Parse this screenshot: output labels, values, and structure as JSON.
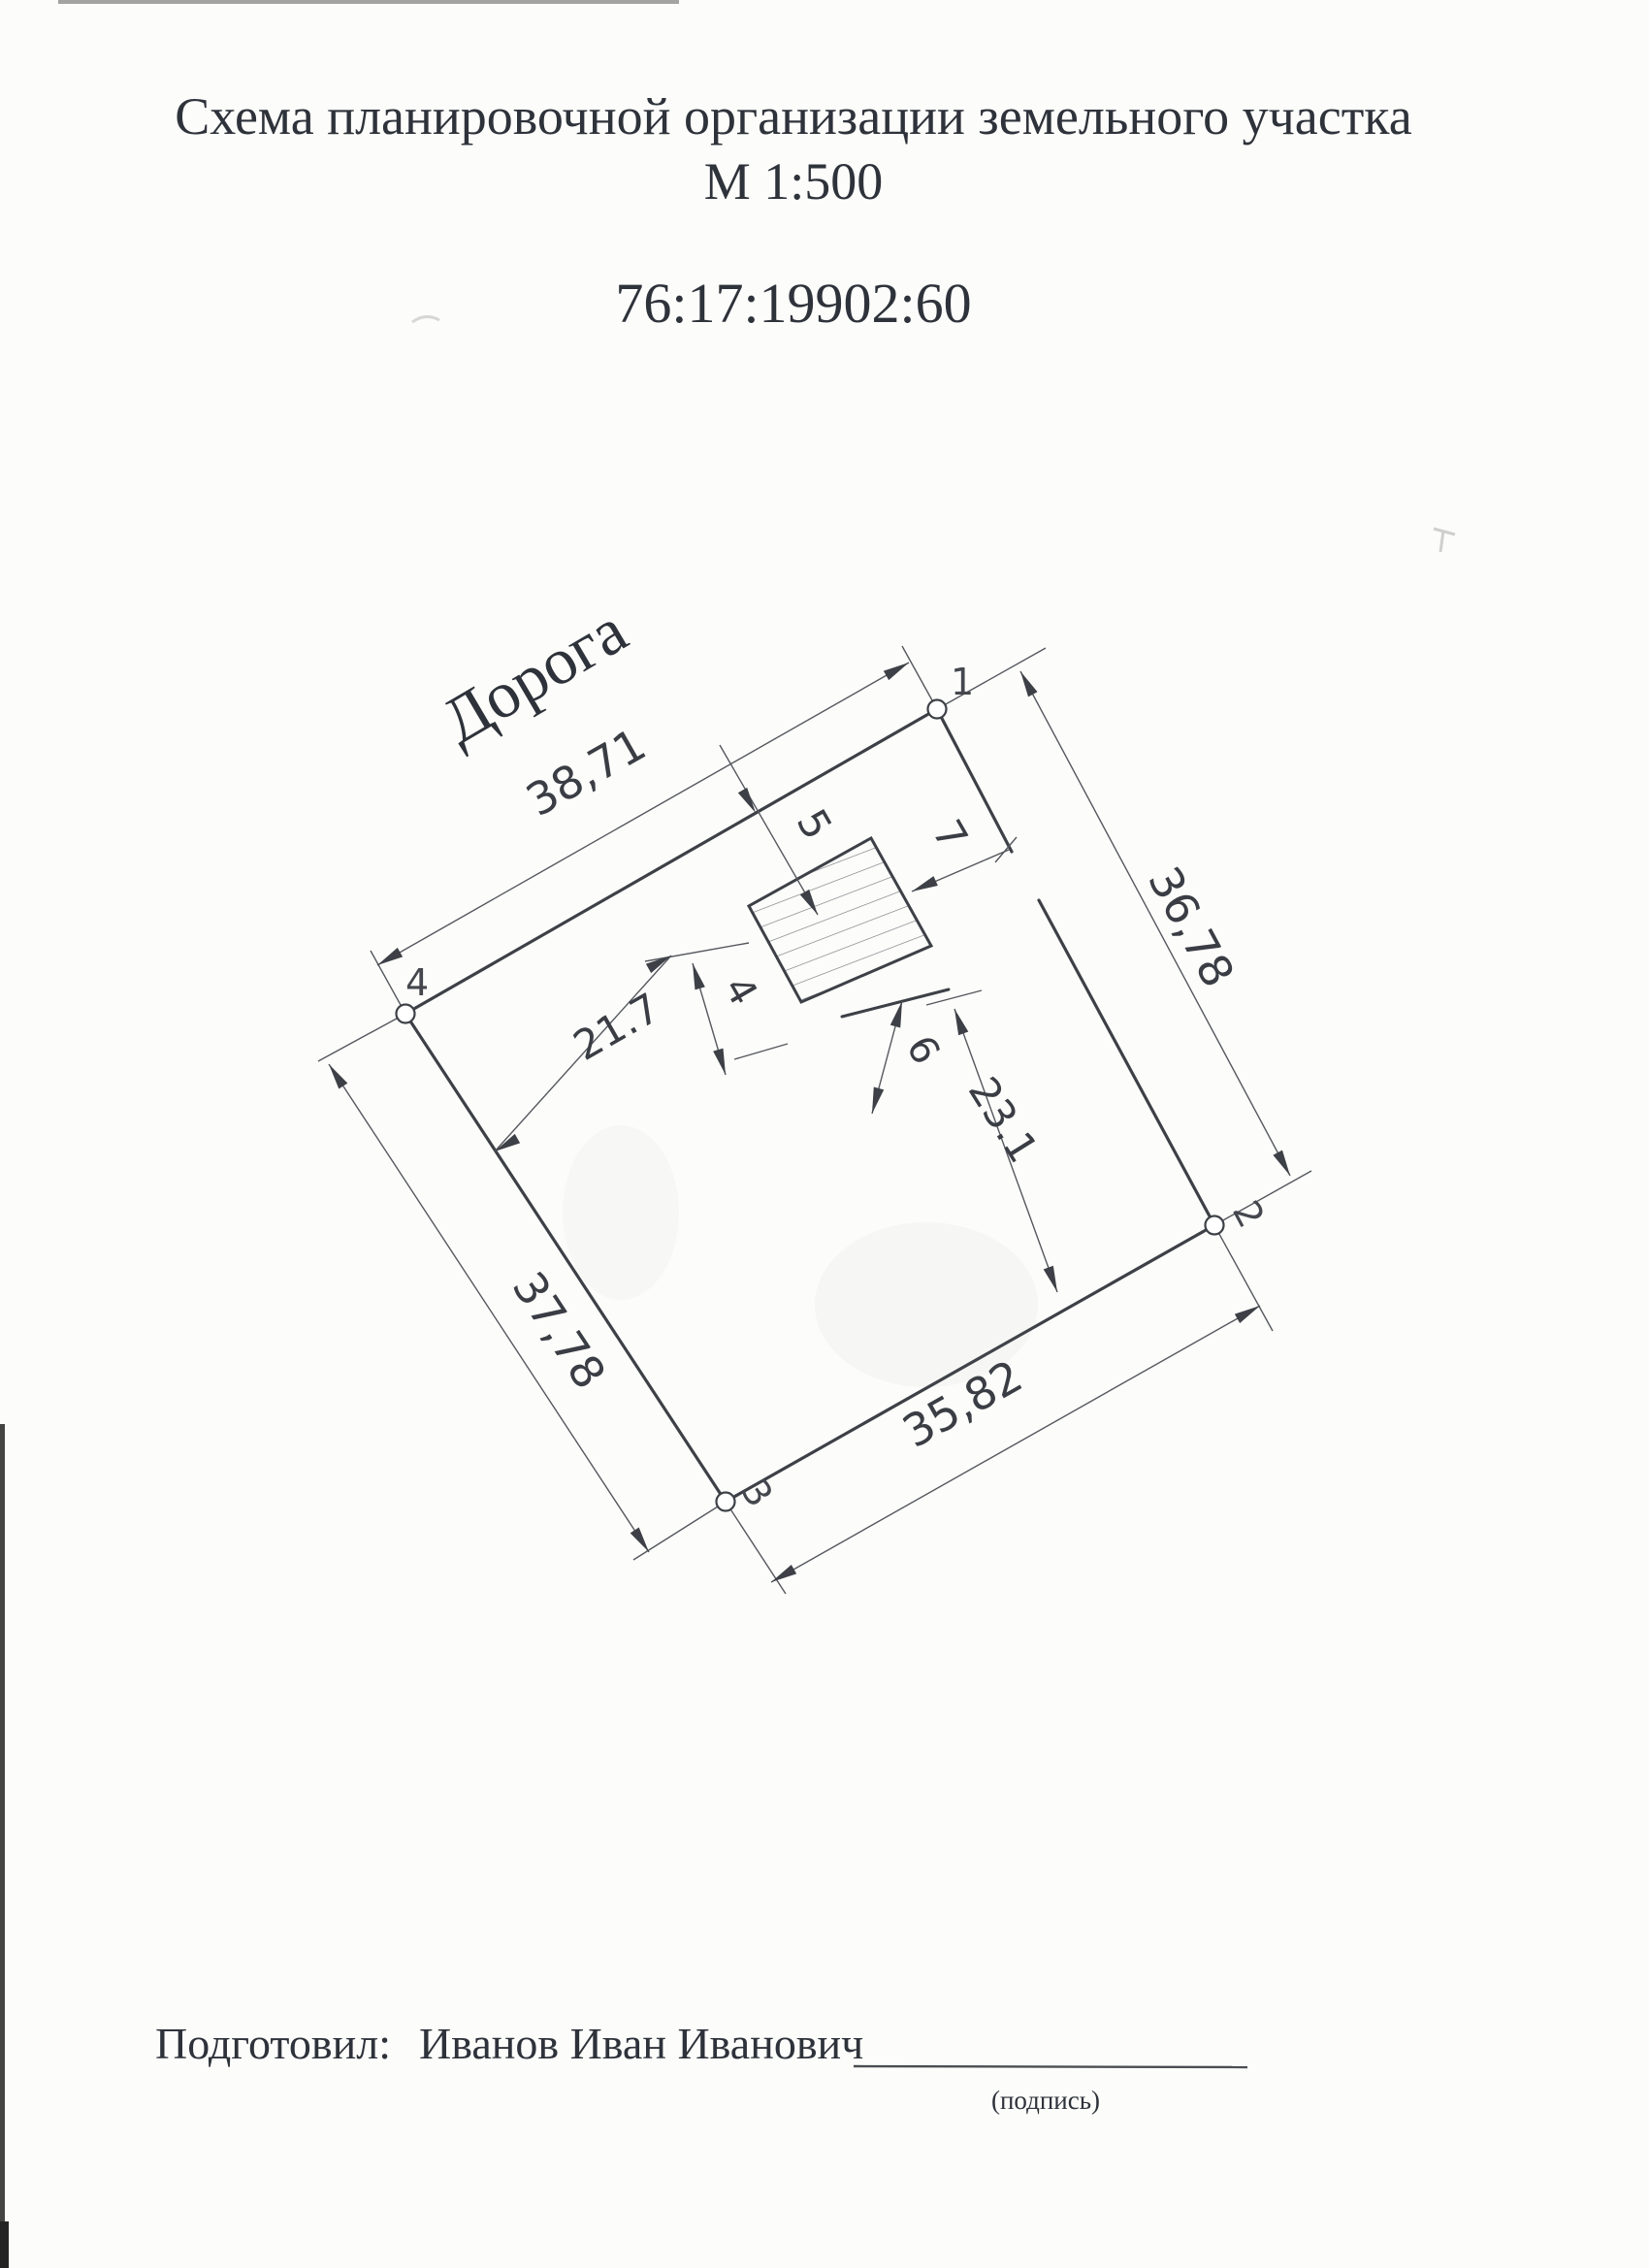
{
  "header": {
    "title_line1": "Схема планировочной организации земельного участка",
    "title_line2": "М 1:500",
    "cadastral_number": "76:17:19902:60"
  },
  "diagram": {
    "road_label": "Дорога",
    "corner_labels": [
      "1",
      "2",
      "3",
      "4"
    ],
    "dimensions": {
      "top_side": "38,71",
      "right_side": "36,78",
      "left_side": "37,78",
      "bottom_side": "35,82",
      "left_to_building": "21.7",
      "building_to_bottom": "23.1",
      "setback_road": "5",
      "setback_right": "7",
      "setback_small_left": "4",
      "setback_small_bottom": "6"
    }
  },
  "footer": {
    "prepared_by_label": "Подготовил:",
    "prepared_by_name": "Иванов Иван Иванович",
    "signature_caption": "(подпись)"
  }
}
